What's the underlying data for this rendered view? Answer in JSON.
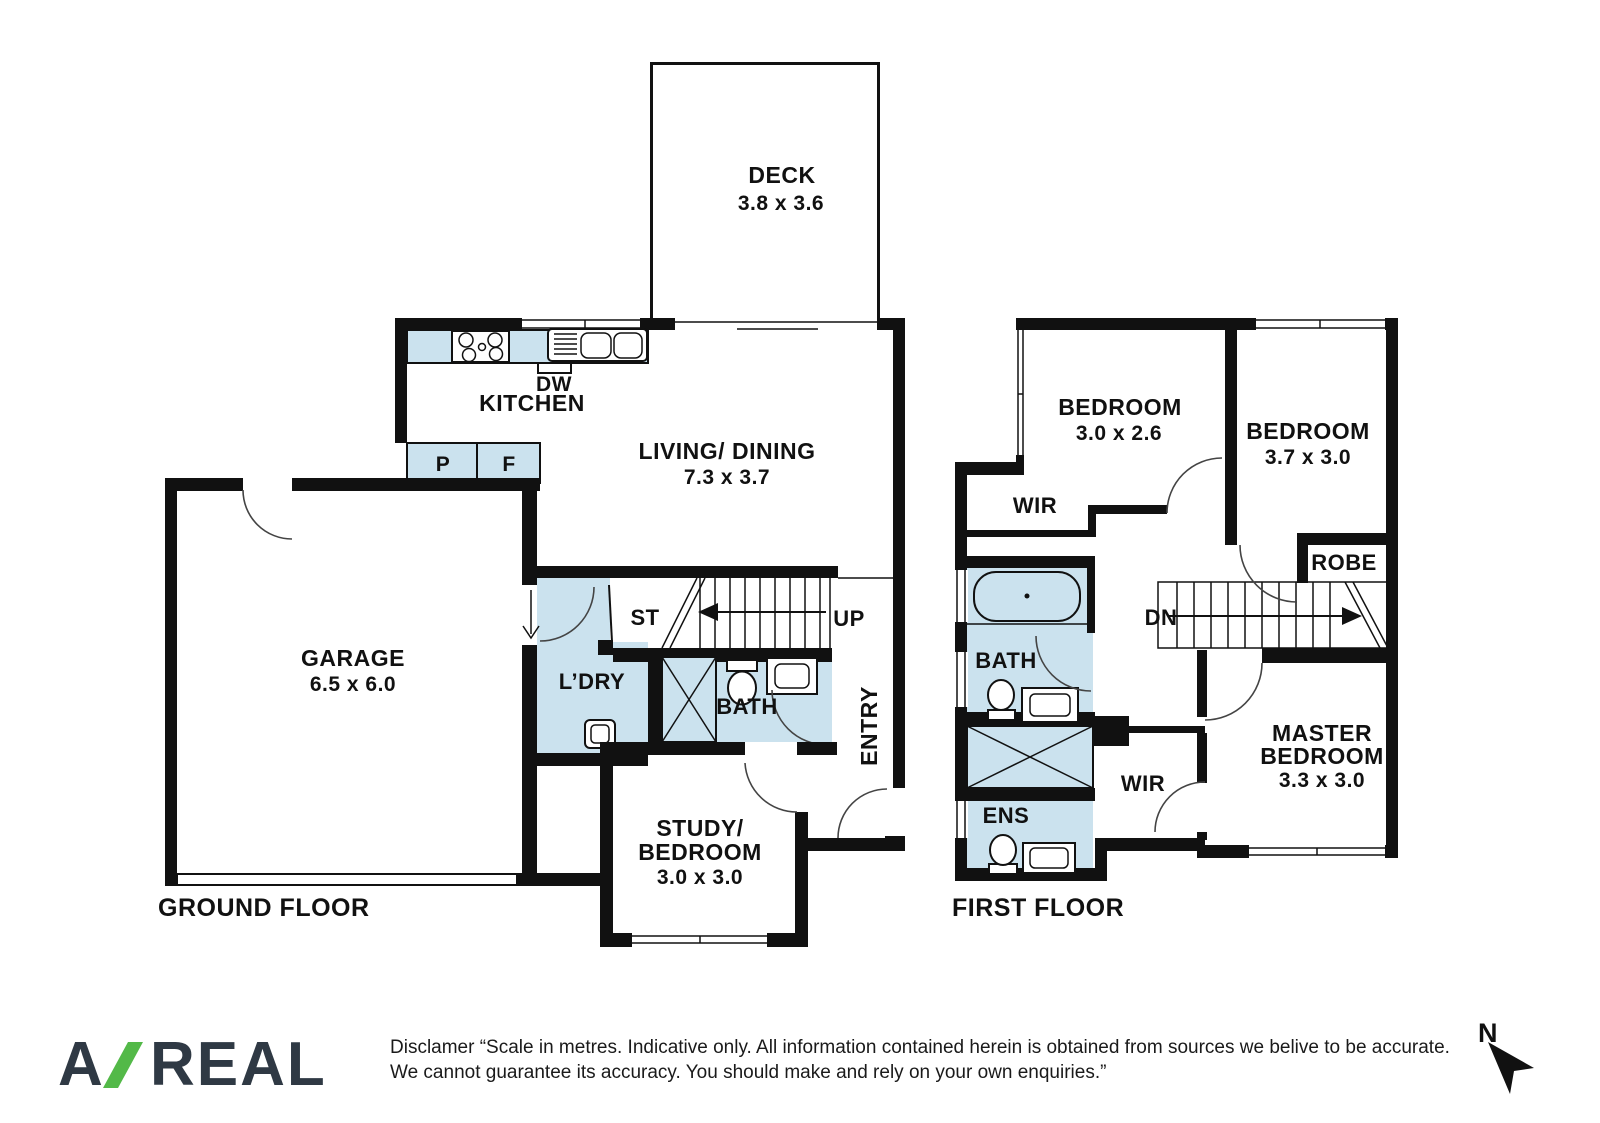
{
  "title": "Two storey floor plan",
  "colors": {
    "wall": "#111111",
    "room_fill": "#cbe2ee",
    "logo_text": "#2f3944",
    "logo_slash": "#53b948"
  },
  "ground_floor": {
    "title": "GROUND FLOOR",
    "deck": {
      "name": "DECK",
      "dims": "3.8 x 3.6"
    },
    "kitchen": {
      "name": "KITCHEN",
      "dishwasher": "DW",
      "pantry": "P",
      "fridge": "F"
    },
    "living": {
      "name": "LIVING/ DINING",
      "dims": "7.3 x 3.7"
    },
    "garage": {
      "name": "GARAGE",
      "dims": "6.5 x 6.0"
    },
    "laundry": {
      "name": "L’DRY"
    },
    "storage": {
      "name": "ST"
    },
    "stairs": {
      "name": "UP"
    },
    "bath": {
      "name": "BATH"
    },
    "entry": {
      "name": "ENTRY"
    },
    "study": {
      "line1": "STUDY/",
      "line2": "BEDROOM",
      "dims": "3.0 x 3.0"
    }
  },
  "first_floor": {
    "title": "FIRST FLOOR",
    "bedroom1": {
      "name": "BEDROOM",
      "dims": "3.0 x 2.6"
    },
    "bedroom2": {
      "name": "BEDROOM",
      "dims": "3.7 x 3.0"
    },
    "wir1": {
      "name": "WIR"
    },
    "robe": {
      "name": "ROBE"
    },
    "bath": {
      "name": "BATH"
    },
    "stairs": {
      "name": "DN"
    },
    "ens": {
      "name": "ENS"
    },
    "wir2": {
      "name": "WIR"
    },
    "master": {
      "line1": "MASTER",
      "line2": "BEDROOM",
      "dims": "3.3 x 3.0"
    }
  },
  "footer": {
    "logo": {
      "part1": "A",
      "part2": "REAL"
    },
    "disclaimer_line1": "Disclamer “Scale in metres. Indicative only. All information contained herein is obtained from sources we belive to be accurate.",
    "disclaimer_line2": "We cannot guarantee its accuracy. You should make and rely on your own enquiries.”",
    "compass": {
      "label": "N"
    }
  }
}
